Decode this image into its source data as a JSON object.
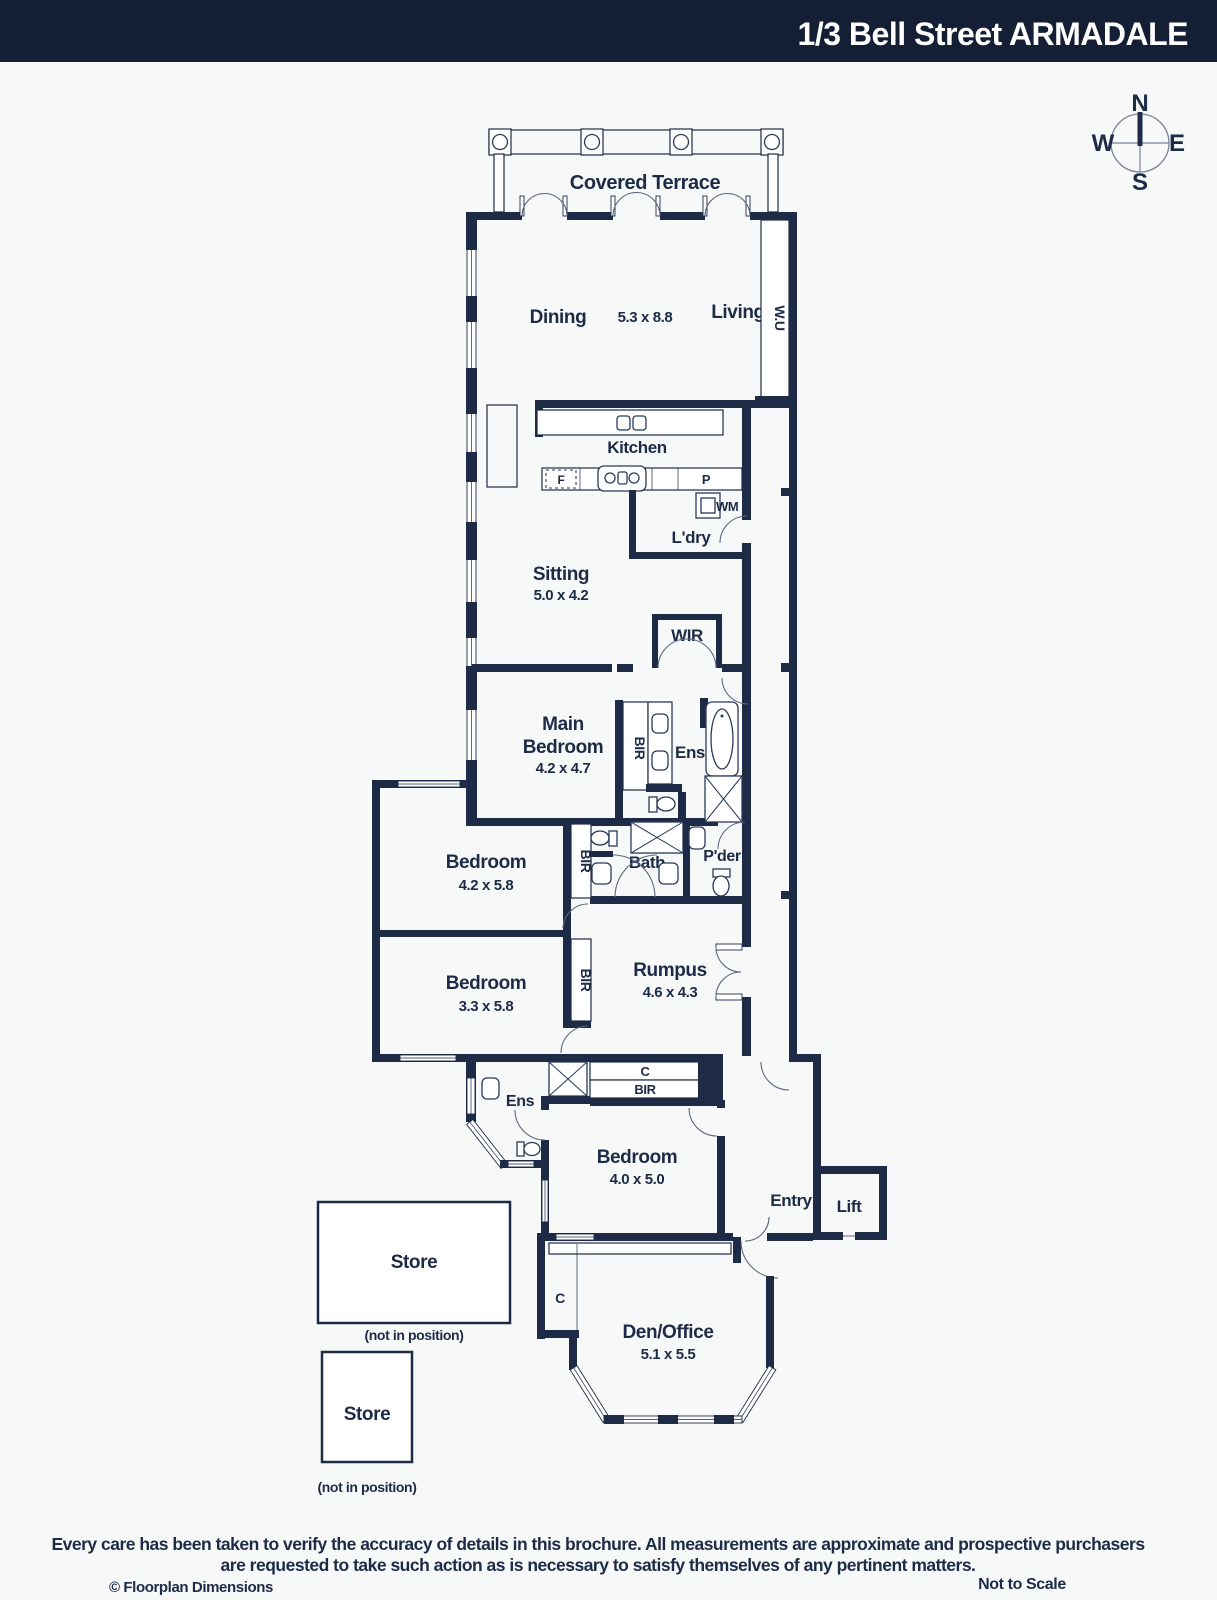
{
  "colors": {
    "wall": "#1d2b47",
    "header_bg": "#141f36",
    "background": "#f7f9f8",
    "accent_white": "#ffffff"
  },
  "header": {
    "title": "1/3 Bell Street ARMADALE"
  },
  "compass": {
    "north": "N",
    "east": "E",
    "south": "S",
    "west": "W"
  },
  "plan": {
    "covered_terrace": "Covered Terrace",
    "dining": "Dining",
    "dining_living_dims": "5.3 x 8.8",
    "living": "Living",
    "wall_unit": "W.U",
    "kitchen": "Kitchen",
    "fridge": "F",
    "pantry": "P",
    "washing_machine": "WM",
    "laundry": "L'dry",
    "sitting": "Sitting",
    "sitting_dims": "5.0 x 4.2",
    "wir": "WIR",
    "main_bedroom_line1": "Main",
    "main_bedroom_line2": "Bedroom",
    "main_bedroom_dims": "4.2 x 4.7",
    "bir": "BIR",
    "ensuite": "Ens",
    "bedroom2": "Bedroom",
    "bedroom2_dims": "4.2 x 5.8",
    "bath": "Bath",
    "powder": "P'der",
    "bedroom3": "Bedroom",
    "bedroom3_dims": "3.3 x 5.8",
    "rumpus": "Rumpus",
    "rumpus_dims": "4.6 x 4.3",
    "cupboard": "C",
    "bedroom4": "Bedroom",
    "bedroom4_dims": "4.0 x 5.0",
    "entry": "Entry",
    "lift": "Lift",
    "store": "Store",
    "not_in_position": "(not in position)",
    "den_office": "Den/Office",
    "den_office_dims": "5.1 x 5.5"
  },
  "footer": {
    "disclaimer_line1": "Every care has been taken to verify the accuracy of details in this brochure. All measurements are approximate and prospective purchasers",
    "disclaimer_line2": "are requested to take such action as is necessary to satisfy themselves of any pertinent matters.",
    "copyright": "© Floorplan Dimensions",
    "not_to_scale": "Not to Scale"
  }
}
